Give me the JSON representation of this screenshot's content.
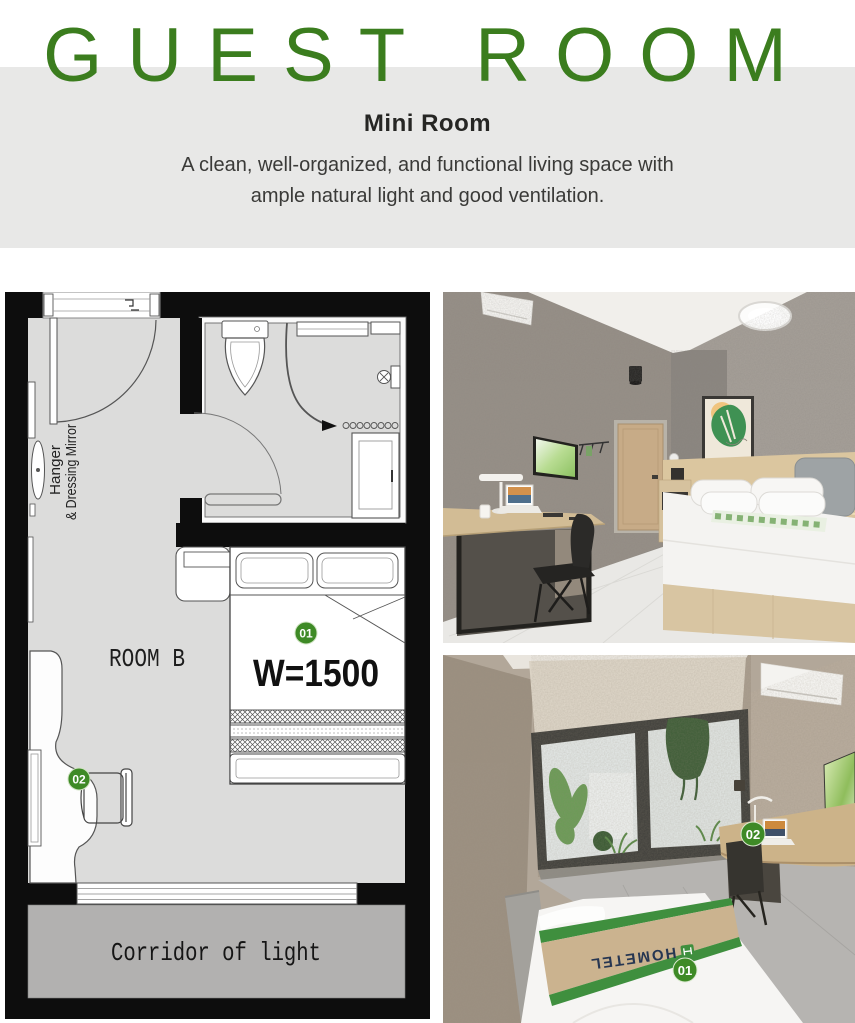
{
  "header": {
    "title": "GUEST ROOM",
    "subtitle": "Mini Room",
    "description_line1": "A clean, well-organized, and functional living space with",
    "description_line2": "ample natural light and good ventilation."
  },
  "floor_plan": {
    "room_label": "ROOM B",
    "bed_width_label": "W=1500",
    "hanger_line1": "Hanger",
    "hanger_line2": "& Dressing Mirror",
    "corridor_label": "Corridor of light",
    "bed_badge": "01",
    "desk_badge": "02"
  },
  "photo_bottom": {
    "bed_badge": "01",
    "desk_badge": "02",
    "bed_runner_brand": "HOMETEL"
  },
  "colors": {
    "accent_green": "#3b7d1e",
    "badge_green": "#3e8a26",
    "runner_green": "#3f8f3e",
    "header_band_gray": "#e8e8e7",
    "plan_floor_gray": "#dcdcdb",
    "corridor_gray": "#b2b1b0"
  }
}
